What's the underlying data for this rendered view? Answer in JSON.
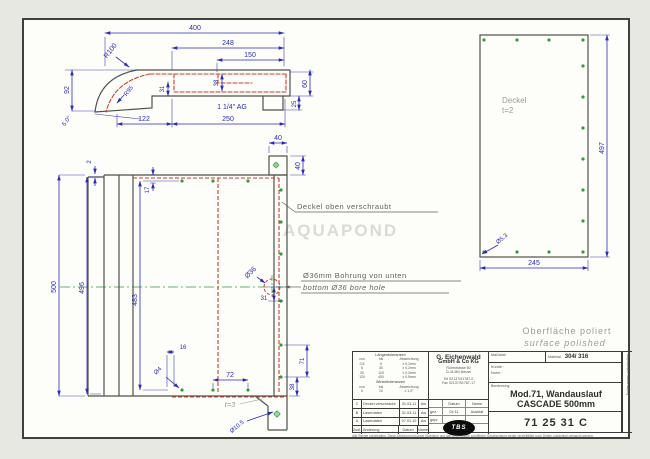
{
  "colors": {
    "dimension": "#2b2bb4",
    "outline": "#51514b",
    "hidden_line": "#c8402c",
    "hole_green": "#339c3c",
    "note_gray": "#9b9b95",
    "paper": "#fdfdfa"
  },
  "watermark": "AQUAPOND",
  "side_view": {
    "d400": "400",
    "d248": "248",
    "d150": "150",
    "d92": "92",
    "r100": "R100",
    "r95": "R95",
    "d38": "38",
    "d31": "31",
    "d60": "60",
    "d25": "25",
    "angle": "5.0°",
    "d122": "122",
    "d250": "250",
    "thread": "1 1/4\" AG"
  },
  "tab_view": {
    "w": "40",
    "h": "40"
  },
  "front_view": {
    "d2": "2",
    "d17": "17",
    "d500": "500",
    "d496": "496",
    "d483": "483",
    "d36": "Ø36",
    "d31": "31",
    "d16": "16",
    "d4": "Ø4",
    "d72": "72",
    "d71": "71",
    "d38": "38",
    "t3": "t=3",
    "d105": "Ø10.5"
  },
  "deckel_view": {
    "label_line1": "Deckel",
    "label_line2": "t=2",
    "d497": "497",
    "d245": "245",
    "d53": "Ø5.3"
  },
  "notes": {
    "deckel_note": "Deckel oben verschraubt",
    "bore_note_de": "Ø36mm Bohrung von unten",
    "bore_note_en": "bottom Ø36 bore hole",
    "surface_de": "Oberfläche poliert",
    "surface_en": "surface polished"
  },
  "title_block": {
    "tol_len_header": "Längentoleranzen",
    "tol_cols": [
      "von",
      "bis",
      "Abweichung"
    ],
    "tol_len_rows": [
      [
        "0,5",
        "6",
        "± 0,1mm"
      ],
      [
        "6",
        "30",
        "± 0,2mm"
      ],
      [
        "30",
        "120",
        "± 0,3mm"
      ],
      [
        "120",
        "400",
        "± 0,5mm"
      ]
    ],
    "tol_ang_header": "Winkeltoleranzen",
    "tol_ang_rows": [
      [
        "0",
        "10",
        "± 1,0°"
      ]
    ],
    "company": {
      "name1": "G. Eichenwald",
      "name2": "GmbH & Co KG",
      "street": "Ruhrstrasse 60",
      "city": "D-41464 Neuss",
      "tel": "Tel 02137/91787-0",
      "fax": "Fax 02137/91787-17"
    },
    "approval": {
      "col_datum": "Datum",
      "col_name": "Name",
      "rows": [
        [
          "gez.",
          "04.11",
          "Ausblat"
        ],
        [
          "gepr.",
          "",
          ""
        ]
      ]
    },
    "scale_label": "Maßstab",
    "material_label": "Material",
    "material_value": "304/ 316",
    "customer_label": "Kunde :",
    "norm_label": "Norm :",
    "designation_label": "Benennung",
    "title_line1": "Mod.71, Wandauslauf",
    "title_line2": "CASCADE 500mm",
    "drawing_number": "71 25 31 C",
    "revisions": [
      [
        "C",
        "Deckel verschraubt",
        "31.03.11",
        "Aw"
      ],
      [
        "B",
        "Laserdaten",
        "31.03.11",
        "Aw"
      ],
      [
        "A",
        "Laserdaten",
        "07.01.10",
        "Aw"
      ]
    ],
    "rev_header": [
      "Zust.",
      "Änderung",
      "Datum",
      "Name"
    ],
    "side_note": "Änderungen vorbehalten",
    "fine_print": "Alle Rechte vorbehalten. Diese Zeichnung ist unser Eigentum und darf ohne unsere schriftliche Genehmigung weder vervielfältigt noch Dritten zugänglich gemacht werden.",
    "logo_text": "TBS"
  }
}
